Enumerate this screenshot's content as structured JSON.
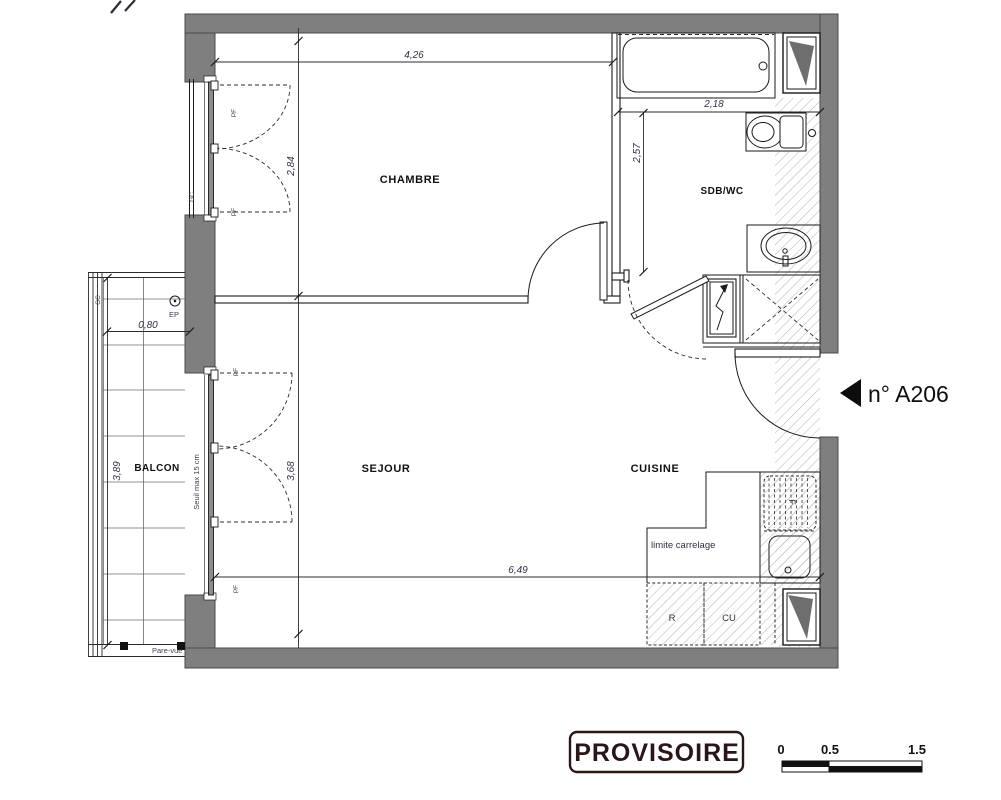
{
  "plan": {
    "rooms": {
      "chambre": "CHAMBRE",
      "sdb_wc": "SDB/WC",
      "sejour": "SEJOUR",
      "cuisine": "CUISINE",
      "balcon": "BALCON"
    },
    "dims": {
      "chambre_width": "4,26",
      "chambre_depth": "2,84",
      "sdb_width": "2,18",
      "sdb_depth": "2,57",
      "balcon_width": "0,80",
      "balcon_depth": "3,89",
      "sejour_depth": "3,68",
      "sejour_width": "6,49"
    },
    "labels": {
      "ep": "EP",
      "seuil": "Seuil max 15 cm",
      "limite_carrelage": "limite carrelage",
      "pare_vue": "Pare-vue",
      "refrigerateur": "R",
      "cuisson": "CU",
      "four": "F",
      "pf": "PF",
      "gc": "GC"
    },
    "unit": {
      "number": "n° A206"
    }
  },
  "footer": {
    "stamp": "PROVISOIRE",
    "scale_ticks": [
      "0",
      "0.5",
      "1.5"
    ]
  },
  "colors": {
    "wall": "#7f7f7f",
    "wall_dark": "#6e6e6e",
    "hatch": "#b8b8b8",
    "stamp": "#2a1616"
  }
}
